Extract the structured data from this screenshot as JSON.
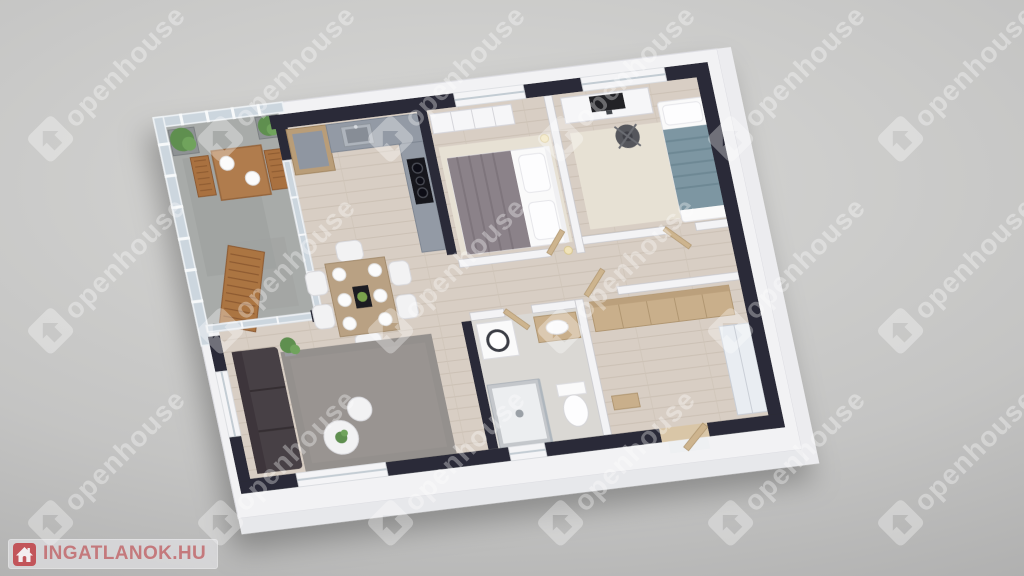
{
  "css_vars": {
    "--bg-center": "#d8d8d6",
    "--bg-mid": "#c4c4c3",
    "--bg-edge": "#a6a6a6",
    "--wm-color": "rgba(255,255,255,0.33)",
    "--logo-bg": "rgba(237,237,240,0.55)",
    "--logo-text-color": "#c4797c",
    "--logo-icon-color": "#c2555a"
  },
  "branding": {
    "logo_text": "INGATLANOK.HU"
  },
  "watermark": {
    "text": "openhouse",
    "positions": [
      [
        95,
        95
      ],
      [
        265,
        95
      ],
      [
        435,
        95
      ],
      [
        605,
        95
      ],
      [
        775,
        95
      ],
      [
        945,
        95
      ],
      [
        95,
        287
      ],
      [
        265,
        287
      ],
      [
        435,
        287
      ],
      [
        605,
        287
      ],
      [
        775,
        287
      ],
      [
        945,
        287
      ],
      [
        95,
        479
      ],
      [
        265,
        479
      ],
      [
        435,
        479
      ],
      [
        605,
        479
      ],
      [
        775,
        479
      ],
      [
        945,
        479
      ]
    ]
  },
  "scene": {
    "description": "3D rendered top-down oblique floor plan of an apartment with balcony",
    "rooms_visible": [
      "balcony",
      "kitchen",
      "dining-area",
      "living-room",
      "bedroom",
      "bedroom-2",
      "hallway",
      "bathroom",
      "walk-in-closet"
    ],
    "palette": {
      "exterior_walls": "#2a2c37",
      "outer_wall_faces": "#f2f2f4",
      "wood_floor": "#d8cec4",
      "balcony_floor": "#a8aba9",
      "bathroom_floor": "#dad8d4",
      "living_rug": "#94908d",
      "bedroom_rug": "#e7e1d4",
      "sofa": "#474044",
      "wood_furniture": "#c9af8b",
      "bed_blanket_main": "#8b8289",
      "bed_blanket_single": "#7d96a2",
      "kitchen_counter": "#939aa5",
      "glass_railing": "#ccd6de"
    }
  }
}
